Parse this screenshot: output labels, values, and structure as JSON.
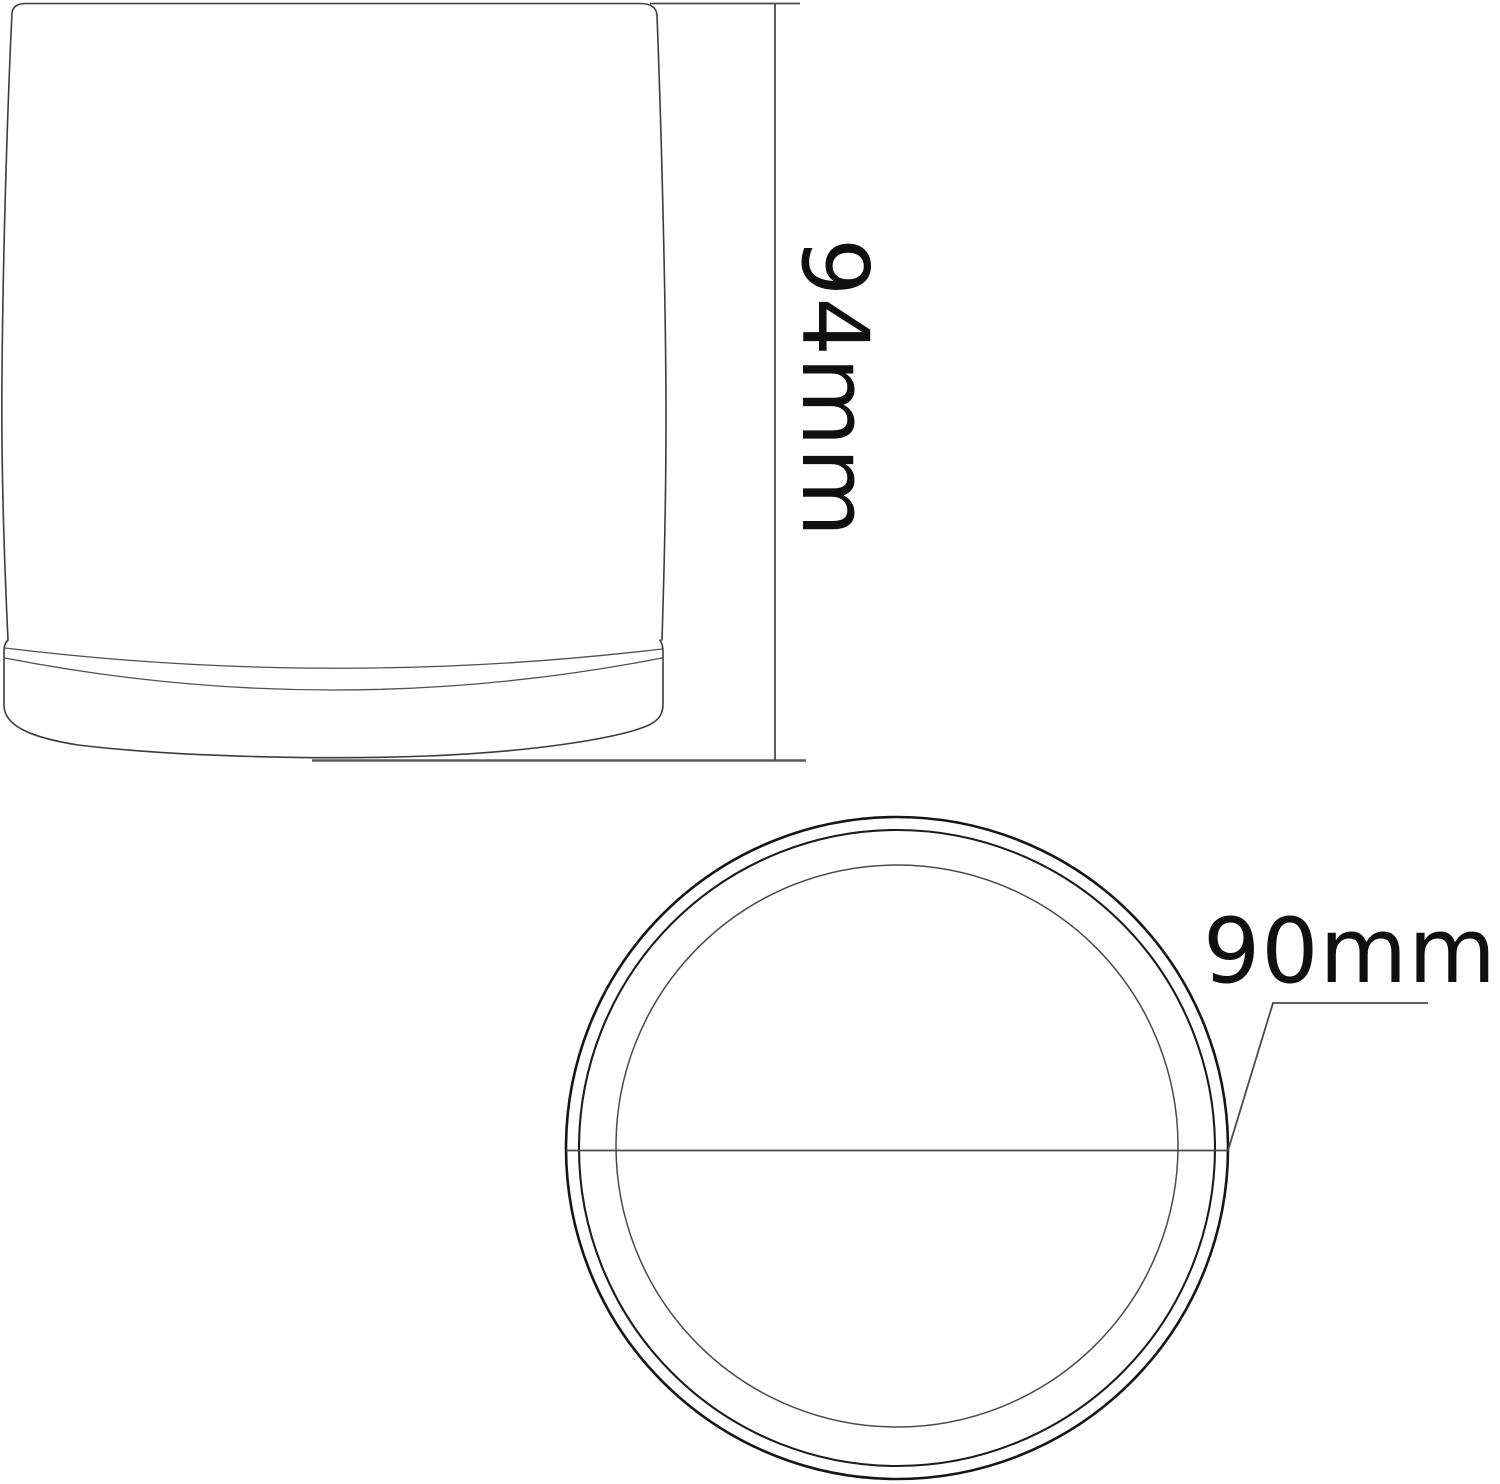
{
  "colors": {
    "background": "#ffffff",
    "object_line": "#3c3c3c",
    "dimension_line": "#4a4a4a",
    "circle_line": "#161616",
    "text": "#101010"
  },
  "side_view": {
    "height_dimension": {
      "label": "94mm",
      "value": 94,
      "unit": "mm"
    }
  },
  "top_view": {
    "diameter_dimension": {
      "label": "90mm",
      "value": 90,
      "unit": "mm"
    }
  }
}
